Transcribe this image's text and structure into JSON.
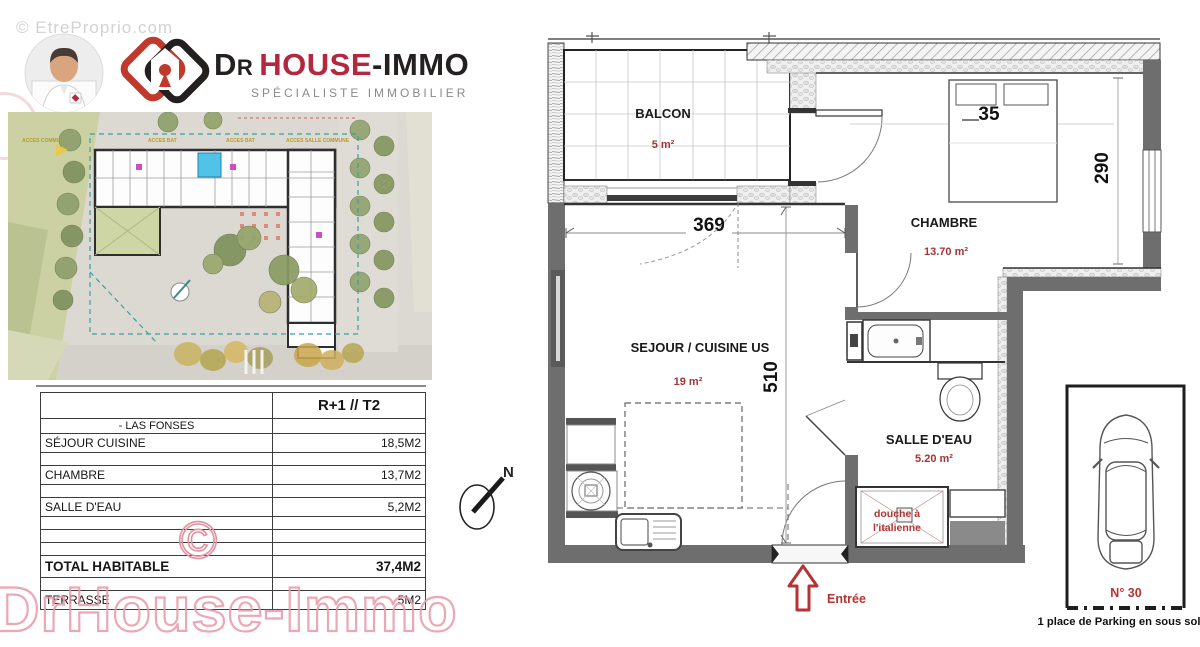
{
  "watermarks": {
    "top": "© EtreProprio.com",
    "big": "DrHouse-Immo",
    "copyright": "©"
  },
  "header": {
    "brand_prefix": "Dr",
    "brand_main": "HOUSE",
    "brand_suffix": "-IMMO",
    "subtitle": "SPÉCIALISTE IMMOBILIER"
  },
  "site_plan": {
    "labels": {
      "left": "ACCES COMMUN",
      "bat1": "ACCES BAT",
      "bat2": "ACCES BAT",
      "common": "ACCES SALLE COMMUNE"
    },
    "compass": "N"
  },
  "area_table": {
    "header": "R+1 // T2",
    "project": "- LAS FONSES",
    "rows": [
      {
        "label": "SÉJOUR CUISINE",
        "value": "18,5M2"
      },
      {
        "label": "CHAMBRE",
        "value": "13,7M2"
      },
      {
        "label": "SALLE D'EAU",
        "value": "5,2M2"
      }
    ],
    "total": {
      "label": "TOTAL HABITABLE",
      "value": "37,4M2"
    },
    "terrace": {
      "label": "TERRASSE",
      "value": "5M2"
    }
  },
  "floor_plan": {
    "rooms": {
      "balcony": {
        "name": "BALCON",
        "area": "5 m²"
      },
      "bedroom": {
        "name": "CHAMBRE",
        "area": "13.70 m²"
      },
      "living": {
        "name": "SEJOUR / CUISINE US",
        "area": "19 m²"
      },
      "bathroom": {
        "name": "SALLE D'EAU",
        "area": "5.20 m²"
      }
    },
    "dims": {
      "living_width": "369",
      "living_height": "510",
      "bedroom_height": "290",
      "bed": "35"
    },
    "shower": {
      "line1": "douche à",
      "line2": "l'italienne"
    },
    "entrance_label": "Entrée",
    "compass": "N"
  },
  "parking": {
    "number": "N° 30",
    "caption": "1 place de Parking en sous sol"
  },
  "colors": {
    "accent_red": "#b03333",
    "brand_red": "#b5273f",
    "highlight_cyan": "#4fc3e8",
    "watermark_pink": "#e79aa8"
  }
}
